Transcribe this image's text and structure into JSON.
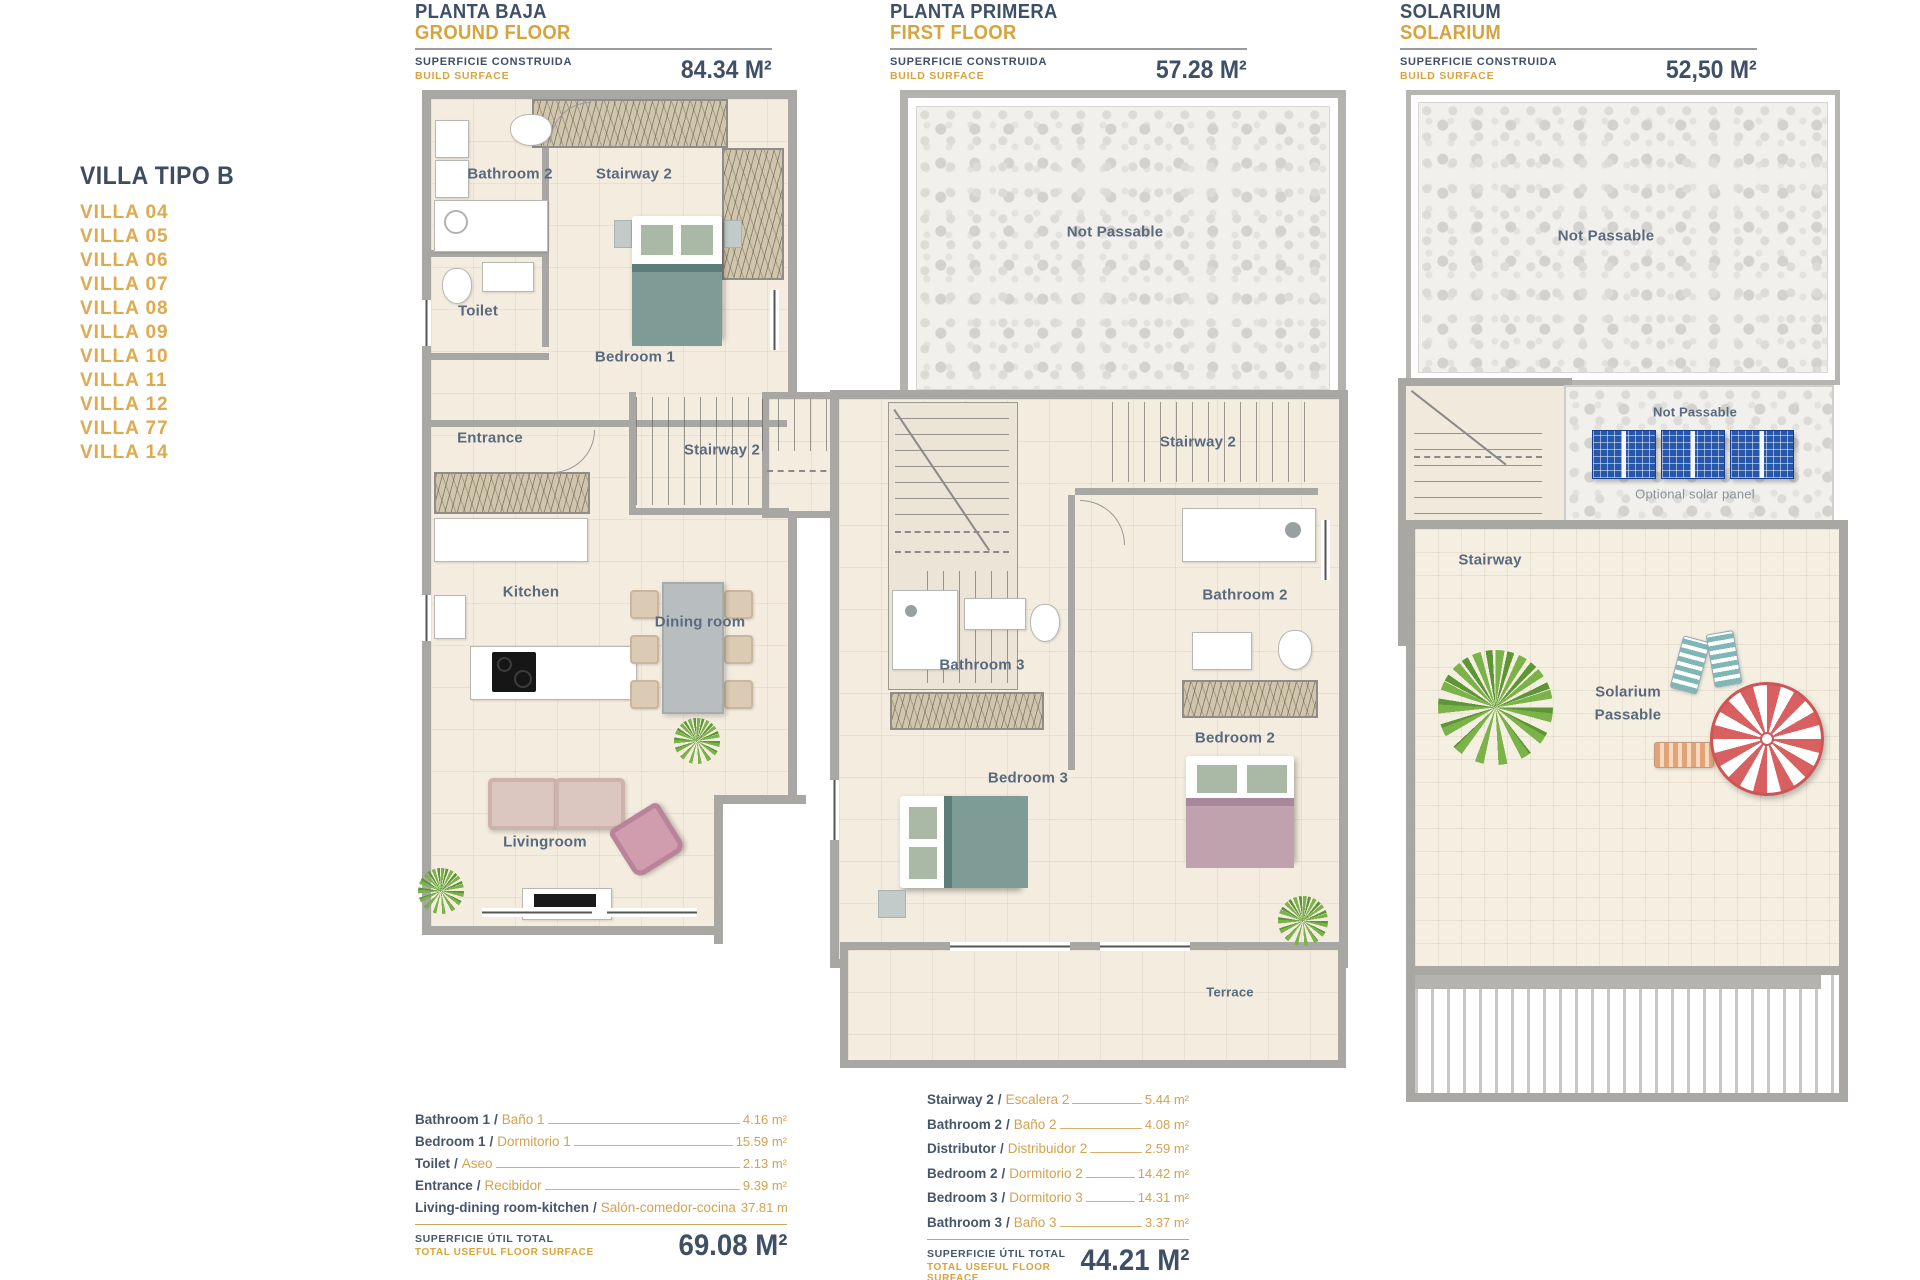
{
  "sep": "/",
  "sidebar": {
    "title": "VILLA TIPO B",
    "villas": [
      "VILLA 04",
      "VILLA 05",
      "VILLA 06",
      "VILLA 07",
      "VILLA 08",
      "VILLA 09",
      "VILLA 10",
      "VILLA 11",
      "VILLA 12",
      "VILLA 77",
      "VILLA 14"
    ]
  },
  "plans": [
    {
      "title_es": "PLANTA BAJA",
      "title_en": "GROUND FLOOR",
      "surface_es": "SUPERFICIE CONSTRUIDA",
      "surface_en": "BUILD SURFACE",
      "area": "84.34 M²",
      "labels": {
        "bathroom2": "Bathroom 2",
        "stairway2_top": "Stairway 2",
        "toilet": "Toilet",
        "bedroom1": "Bedroom 1",
        "entrance": "Entrance",
        "stairway2_mid": "Stairway 2",
        "kitchen": "Kitchen",
        "dining_room": "Dining room",
        "livingroom": "Livingroom"
      },
      "legend": {
        "rows": [
          {
            "en": "Bathroom 1",
            "es": "Baño 1",
            "area": "4.16 m²"
          },
          {
            "en": "Bedroom 1",
            "es": "Dormitorio 1",
            "area": "15.59 m²"
          },
          {
            "en": "Toilet",
            "es": "Aseo",
            "area": "2.13 m²"
          },
          {
            "en": "Entrance",
            "es": "Recibidor",
            "area": "9.39 m²"
          },
          {
            "en": "Living-dining room-kitchen",
            "es": "Salón-comedor-cocina",
            "area": "37.81 m"
          }
        ],
        "total_label_es": "SUPERFICIE ÚTIL TOTAL",
        "total_label_en": "TOTAL USEFUL FLOOR SURFACE",
        "total_value": "69.08 M²"
      }
    },
    {
      "title_es": "PLANTA PRIMERA",
      "title_en": "FIRST FLOOR",
      "surface_es": "SUPERFICIE CONSTRUIDA",
      "surface_en": "BUILD SURFACE",
      "area": "57.28 M²",
      "labels": {
        "not_passable": "Not Passable",
        "stairway2": "Stairway 2",
        "bathroom2": "Bathroom 2",
        "bathroom3": "Bathroom 3",
        "bedroom3": "Bedroom 3",
        "bedroom2": "Bedroom 2",
        "terrace": "Terrace"
      },
      "legend": {
        "rows": [
          {
            "en": "Stairway 2",
            "es": "Escalera 2",
            "area": "5.44 m²"
          },
          {
            "en": "Bathroom 2",
            "es": "Baño 2",
            "area": "4.08 m²"
          },
          {
            "en": "Distributor",
            "es": "Distribuidor 2",
            "area": "2.59 m²"
          },
          {
            "en": "Bedroom 2",
            "es": "Dormitorio 2",
            "area": "14.42 m²"
          },
          {
            "en": "Bedroom 3",
            "es": "Dormitorio 3",
            "area": "14.31 m²"
          },
          {
            "en": "Bathroom 3",
            "es": "Baño 3",
            "area": "3.37 m²"
          }
        ],
        "total_label_es": "SUPERFICIE ÚTIL TOTAL",
        "total_label_en": "TOTAL USEFUL FLOOR SURFACE",
        "total_value": "44.21 M²"
      }
    },
    {
      "title_es": "SOLARIUM",
      "title_en": "SOLARIUM",
      "surface_es": "SUPERFICIE CONSTRUIDA",
      "surface_en": "BUILD SURFACE",
      "area": "52,50 M²",
      "labels": {
        "not_passable_top": "Not Passable",
        "not_passable_panels": "Not Passable",
        "optional_solar_panel": "Optional solar panel",
        "stairway": "Stairway",
        "solarium_line1": "Solarium",
        "solarium_line2": "Passable"
      }
    }
  ]
}
